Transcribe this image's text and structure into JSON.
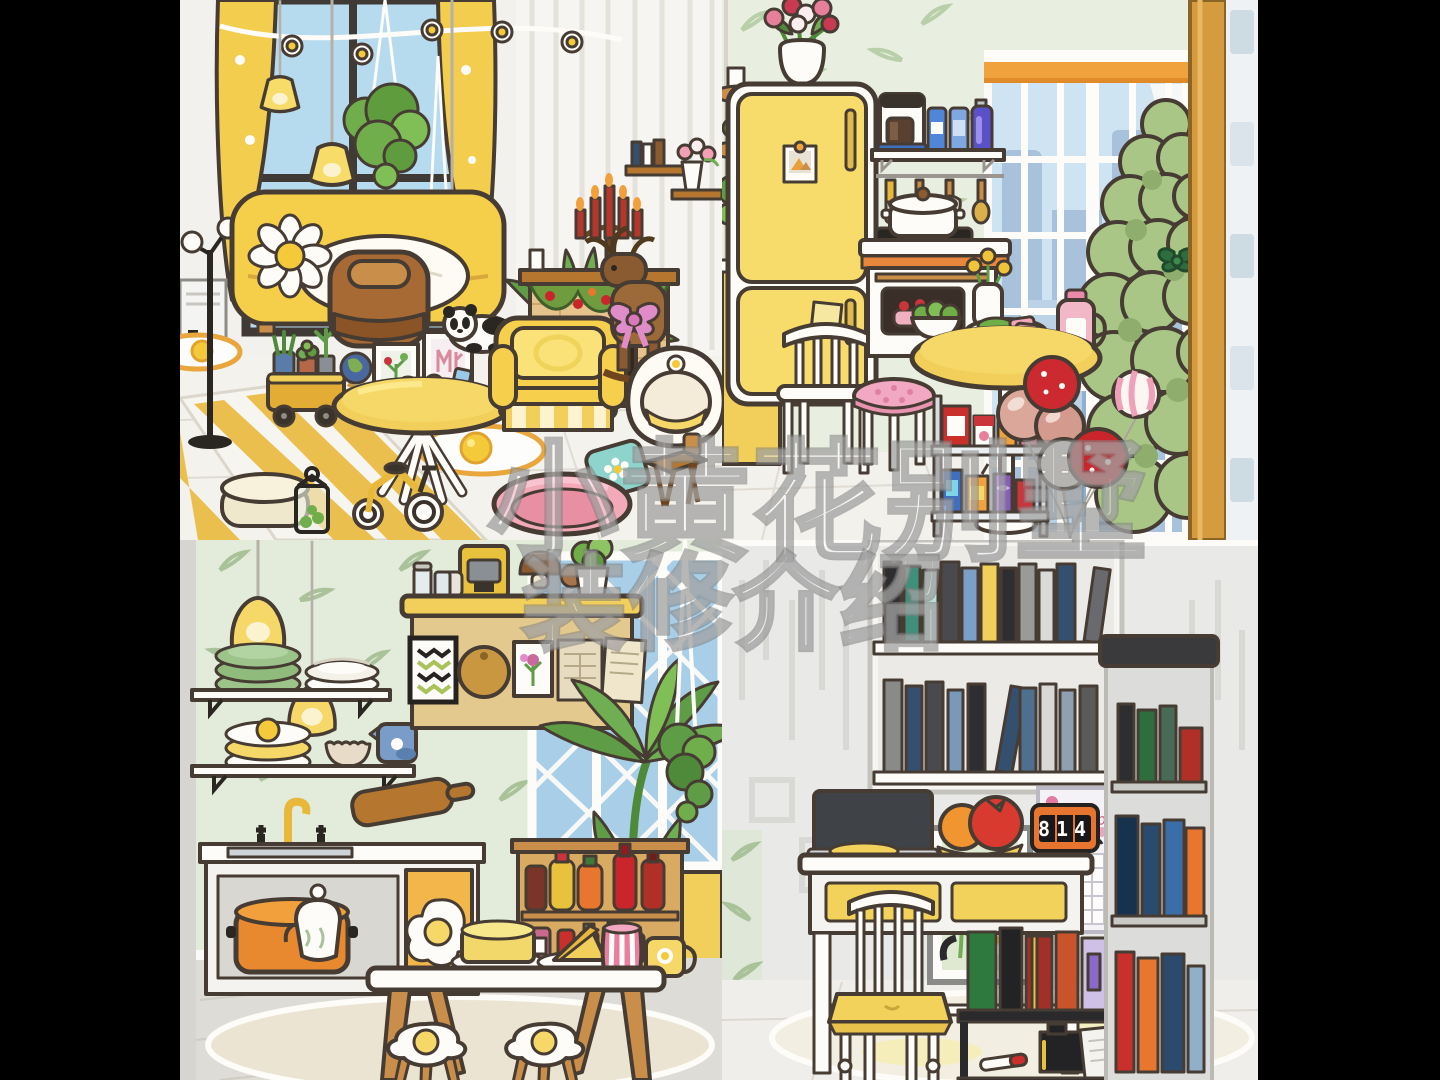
{
  "meta": {
    "description": "Toca-style dollhouse collage: four room scenes in a 2x2 grid with black side bars and a translucent Chinese watermark",
    "layout": "2x2 grid"
  },
  "watermark": {
    "line1": "小黄花别墅",
    "line2": "装修介绍"
  },
  "palette": {
    "black_bars": "#000000",
    "accent_yellow": "#F2CF5A",
    "deep_yellow": "#E8B83A",
    "outline_brown": "#473C33",
    "wall_green": "#E3ECDB",
    "leaf_green": "#A9C29A",
    "window_blue": "#AED4EA",
    "city_blue": "#A9C2DC",
    "wood": "#C98F4A",
    "red": "#C9252B",
    "pink": "#F2A8C2",
    "rose_gold": "#DCA79B",
    "floor_white": "#F3F1EC",
    "rug_beige": "#ECE4D2"
  },
  "rooms": {
    "living_room": {
      "position": "top-left",
      "items": [
        "yellow curtains",
        "window",
        "egg-daisy garland",
        "pendant lamps",
        "hanging plants",
        "air conditioner",
        "floor lamp",
        "yellow sofa",
        "daisy pillow",
        "white blanket",
        "brown armchair",
        "panda plush",
        "yellow armchair",
        "round coffee table",
        "picture frames",
        "globe",
        "plant cart",
        "fireplace",
        "red candelabra",
        "holiday garland",
        "wooden reindeer with pink bow",
        "egg pod chair",
        "wooden stool",
        "striped rug",
        "fried egg rugs",
        "cream pouf",
        "lantern",
        "tricycle",
        "pink pet bed with teal daisy pillow",
        "palm plant",
        "wall shelves with books and pink flowers"
      ]
    },
    "kitchen": {
      "position": "top-right",
      "items": [
        "leaf wallpaper",
        "yellow fridge",
        "tulip vase",
        "polaroid magnet",
        "sticky note",
        "shelf with coffee maker and blue bottles",
        "utensil rail",
        "stove with pot",
        "oven with strawberry cake",
        "round pedestal table",
        "plate of food",
        "pink jug",
        "flower vase",
        "salad bowl",
        "white spindle chair",
        "pink tufted stool",
        "snack cart",
        "balloon bouquet",
        "fir tree with green bow",
        "city window with orange shades",
        "wooden pillar",
        "blue tile strip",
        "yellow half wall",
        "corner plant shelves"
      ]
    },
    "dining_kitchen": {
      "position": "bottom-left",
      "items": [
        "leaf wallpaper",
        "yellow pendant lamps",
        "wall shelves",
        "green plates",
        "white plates",
        "yellow plates",
        "bowl",
        "blue jug",
        "island counter",
        "coffee machine",
        "glass jars",
        "mushroom decor",
        "lettuce pot",
        "chevron artwork",
        "round cutting board",
        "flower artwork",
        "hanging papers",
        "palm plant",
        "hanging plant",
        "lattice window",
        "yellow door",
        "sink counter with taps",
        "yellow faucet",
        "orange pot",
        "fried-egg cabinet",
        "cutting board",
        "sauce hutch with ketchup and mustard",
        "dining table",
        "teapot",
        "yellow cake",
        "cheese wedge",
        "pink striped cup",
        "yellow mug",
        "fried-egg stools",
        "round rug"
      ]
    },
    "study": {
      "position": "bottom-right",
      "items": [
        "wall bookshelf with books",
        "calendar",
        "leaf artwork",
        "white desk with yellow drawers",
        "laptop",
        "mouse pad",
        "fruit plate",
        "flip clock",
        "white chair with yellow cushion",
        "black book cart",
        "ink bottle",
        "notepad",
        "marker",
        "tall gray bookcase",
        "round rug",
        "leaf wallpaper strip"
      ],
      "calendar": {
        "month": "September"
      },
      "flip_clock": {
        "digits": "814"
      }
    }
  }
}
